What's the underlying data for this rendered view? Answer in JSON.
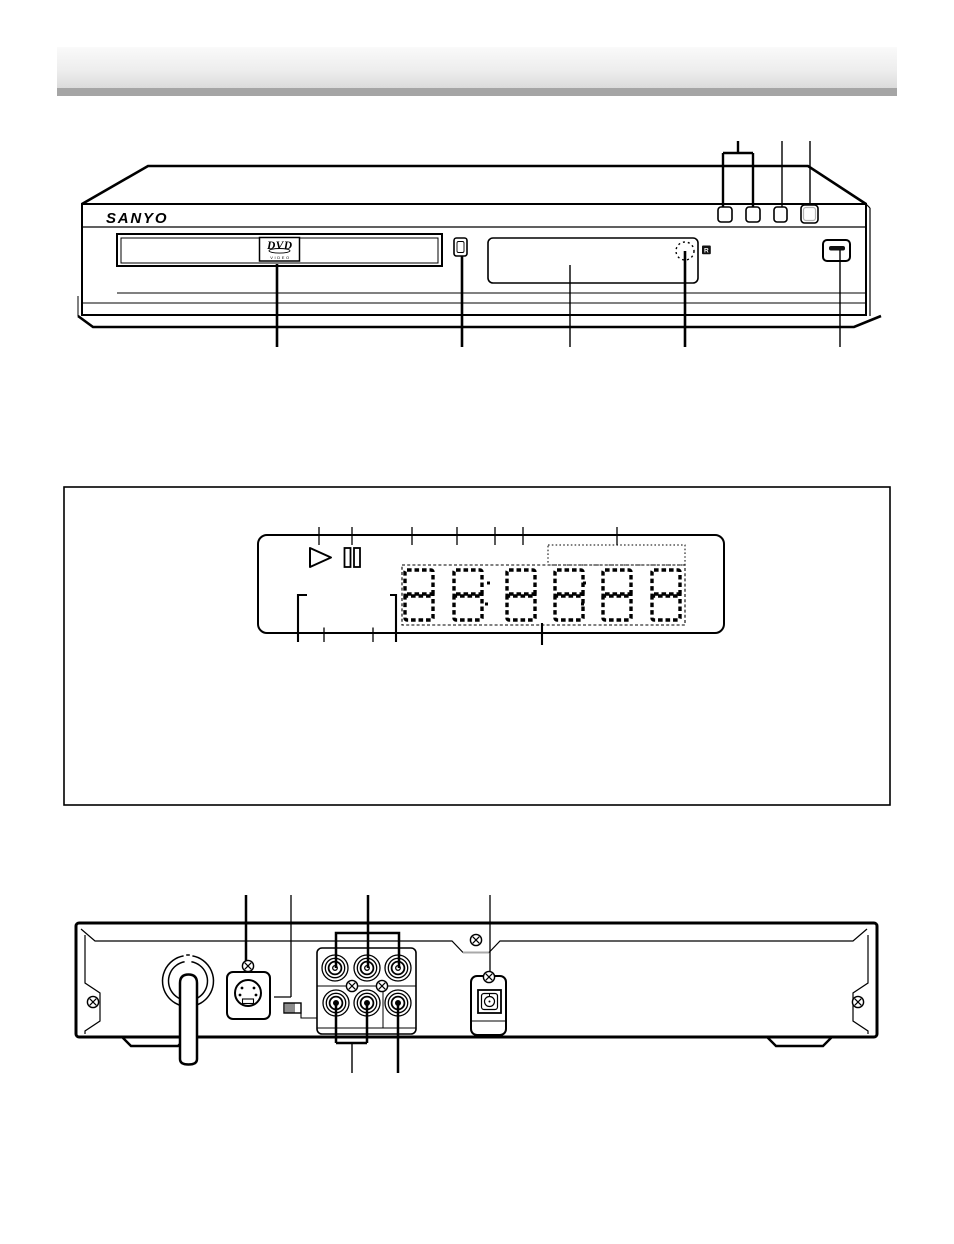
{
  "page": {
    "description": "DVD player owner's manual parts-identification diagram page (front view, display panel detail, rear view)",
    "background": "#ffffff",
    "line_color": "#000000"
  },
  "header": {
    "bar_top_color": "#f9f9f9",
    "bar_mid_color": "#e9e9e9",
    "bar_bottom_band_color": "#a5a5a5"
  },
  "front_view": {
    "brand_logo": "SANYO",
    "disc_tray_badge": {
      "title": "DVD",
      "subtitle": "VIDEO"
    },
    "remote_sensor_badge": "R",
    "icons": [
      "disc-tray",
      "stop-button",
      "display-window",
      "ir-sensor-icon",
      "power-button",
      "play-button",
      "skip-button",
      "open-close-button",
      "standby-button"
    ]
  },
  "display_panel_detail": {
    "icons": [
      "play-indicator-icon",
      "pause-indicator-icon"
    ],
    "digits": "88:88:88"
  },
  "rear_view": {
    "icons": [
      "ac-power-cord",
      "s-video-output-jack",
      "video-switch",
      "audio-video-output-jacks",
      "optical-digital-audio-output",
      "chassis-screws",
      "feet"
    ]
  }
}
